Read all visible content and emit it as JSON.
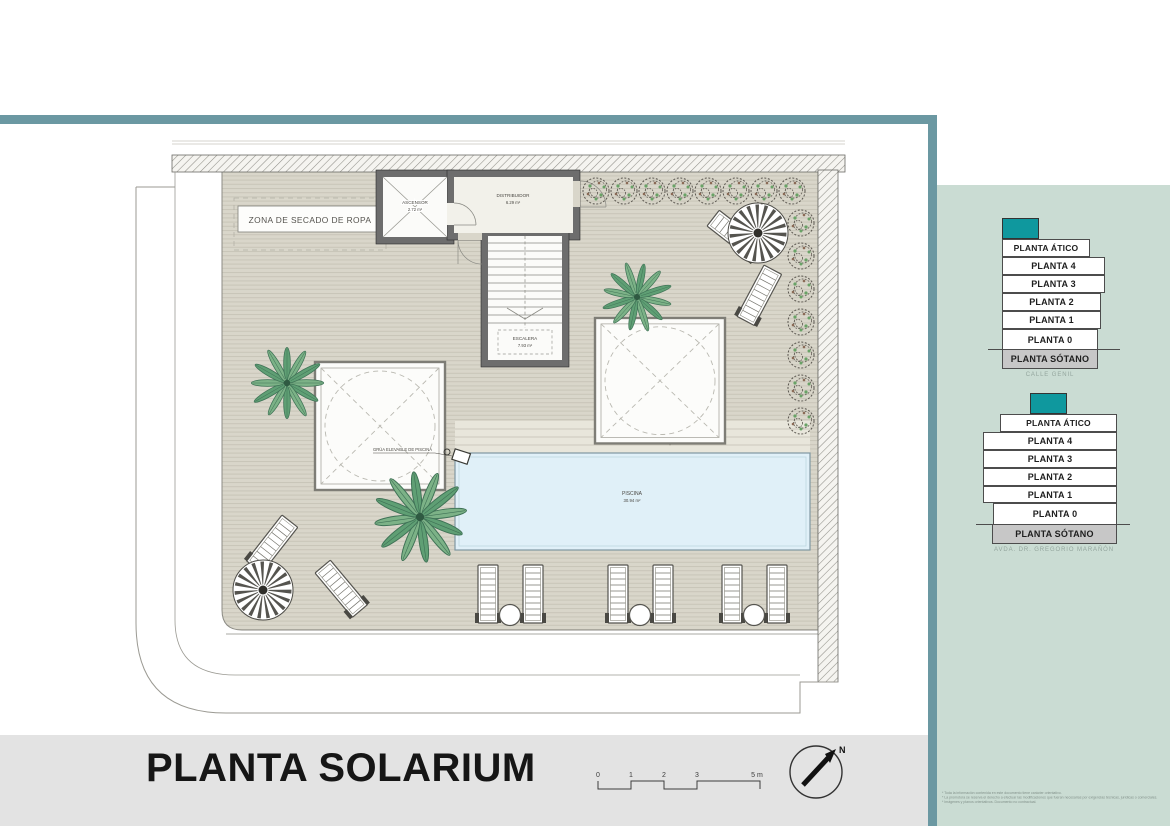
{
  "title": {
    "label": "PLANTA SOLARIUM"
  },
  "north": {
    "label": "N"
  },
  "scale_bar": {
    "ticks": [
      "0",
      "1",
      "2",
      "3",
      "5 m"
    ]
  },
  "plan": {
    "drying_zone_label": "ZONA DE SECADO DE ROPA",
    "crane_label": "GRÚA ELEVABLE DE PISCINA",
    "rooms": {
      "ascensor": {
        "name": "ASCENSOR",
        "area": "2.72 m²"
      },
      "distribuidor": {
        "name": "DISTRIBUIDOR",
        "area": "6.29 m²"
      },
      "escalera": {
        "name": "ESCALERA",
        "area": "7.93 m²"
      },
      "piscina": {
        "name": "PISCINA",
        "area": "30.94 m²"
      }
    }
  },
  "level_stacks": [
    {
      "street": "CALLE GENIL",
      "levels": [
        "PLANTA ÁTICO",
        "PLANTA 4",
        "PLANTA 3",
        "PLANTA 2",
        "PLANTA 1",
        "PLANTA 0",
        "PLANTA SÓTANO"
      ]
    },
    {
      "street": "AVDA. DR. GREGORIO MARAÑÓN",
      "levels": [
        "PLANTA ÁTICO",
        "PLANTA 4",
        "PLANTA 3",
        "PLANTA 2",
        "PLANTA 1",
        "PLANTA 0",
        "PLANTA SÓTANO"
      ]
    }
  ],
  "colors": {
    "accent_teal": "#0f989e",
    "frame_teal": "#6b98a2",
    "panel_sage": "#cadcd3",
    "pool_blue": "#e0f0f8",
    "deck_gray": "#d9d6ca"
  },
  "disclaimer": {
    "lines": [
      "* Toda la información contenida en este documento tiene carácter orientativo.",
      "* La promotora se reserva el derecho a efectuar las modificaciones que fueran necesarias por exigencias técnicas, jurídicas o comerciales.",
      "* Imágenes y planos orientativos. Documento no contractual."
    ]
  }
}
